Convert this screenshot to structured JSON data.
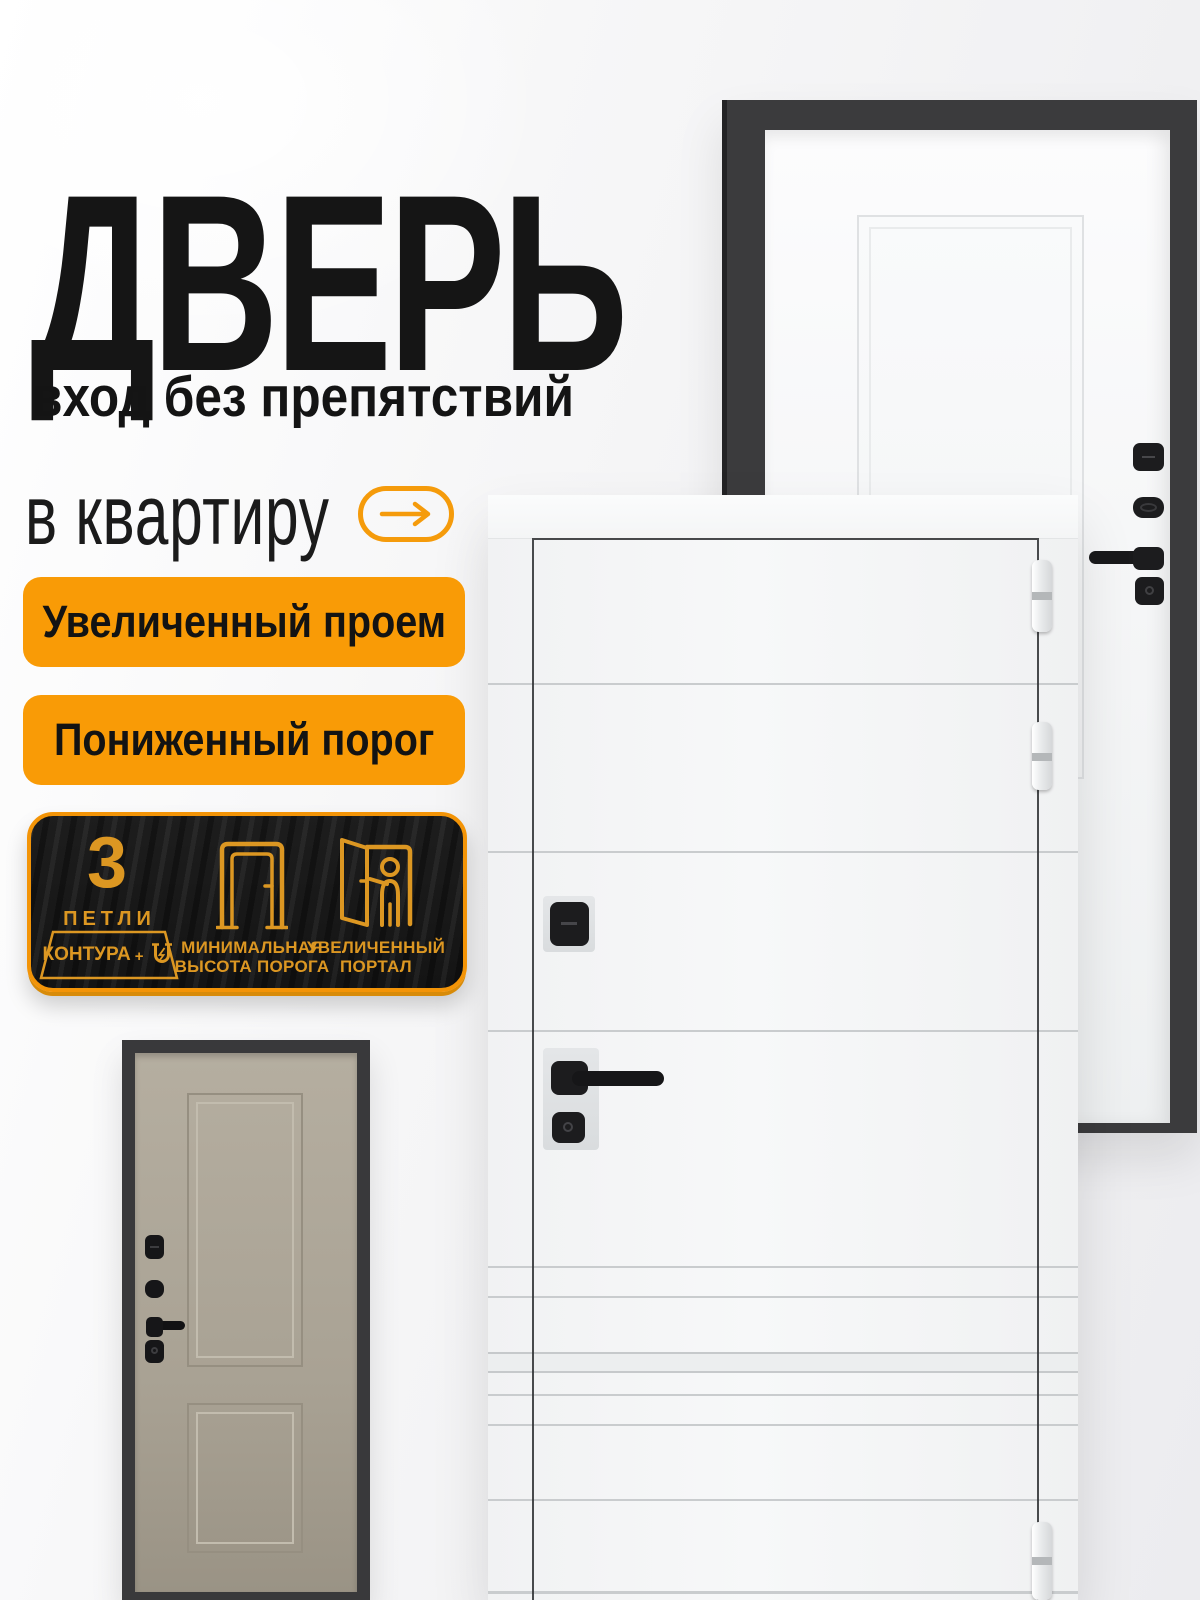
{
  "brand_colors": {
    "accent_orange": "#F99B06",
    "plaque_border_orange": "#F39407",
    "plaque_gold": "#DC9722",
    "ink_black": "#151515",
    "door_frame_dark": "#3B3B3D",
    "door_white": "#F5F6F7",
    "door_beige": "#A9A294"
  },
  "hero": {
    "title": "ДВЕРЬ",
    "subtitle": "вход без препятствий",
    "tagline": "в квартиру"
  },
  "feature_badges": [
    {
      "label": "Увеличенный проем"
    },
    {
      "label": "Пониженный порог"
    }
  ],
  "spec_plaque": {
    "hinges": {
      "count": "3",
      "label": "ПЕТЛИ",
      "contour": "КОНТУРА",
      "plus": "+",
      "icon": "magnet-icon"
    },
    "threshold": {
      "line1": "МИНИМАЛЬНАЯ",
      "line2": "ВЫСОТА ПОРОГА",
      "icon": "door-frame-icon"
    },
    "portal": {
      "line1": "УВЕЛИЧЕННЫЙ",
      "line2": "ПОРТАЛ",
      "icon": "open-door-icon"
    }
  }
}
